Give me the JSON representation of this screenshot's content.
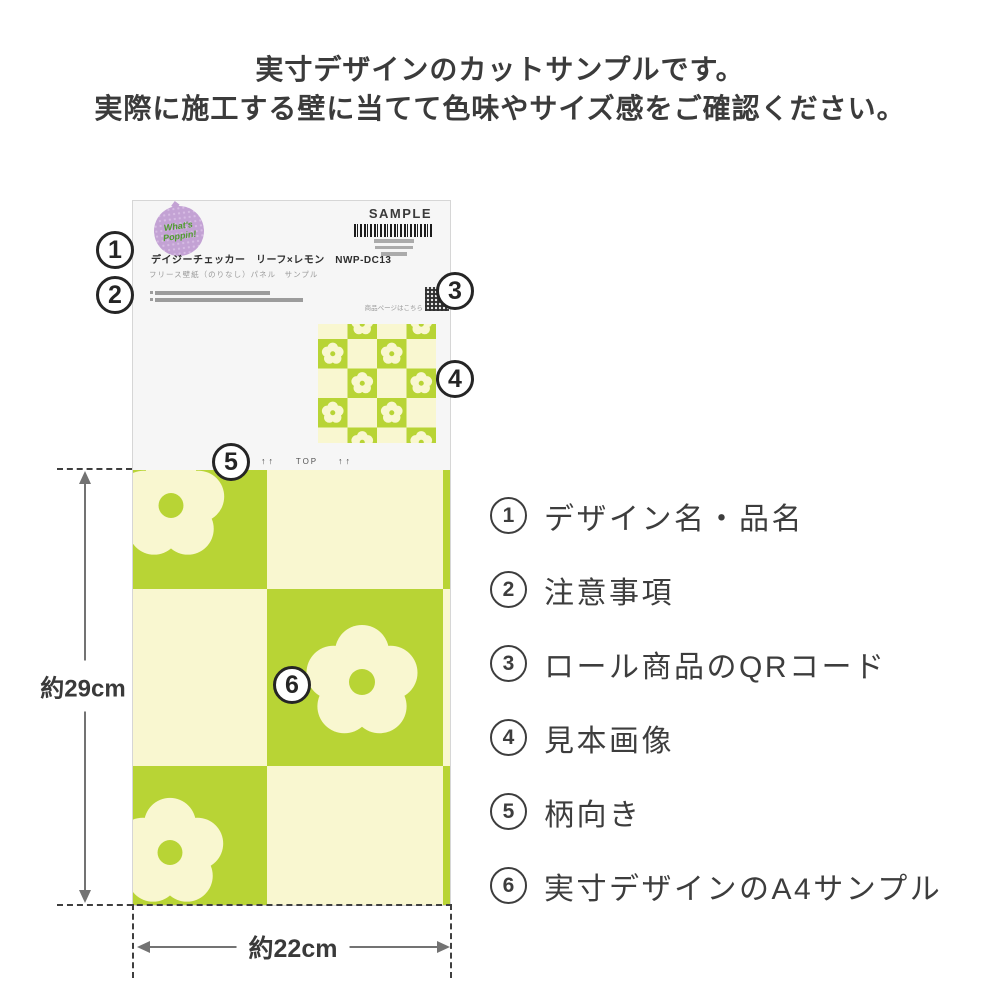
{
  "header": {
    "line1": "実寸デザインのカットサンプルです。",
    "line2": "実際に施工する壁に当てて色味やサイズ感をご確認ください。"
  },
  "sample": {
    "brand_line1": "What's",
    "brand_line2": "Poppin!",
    "sample_label": "SAMPLE",
    "product_name": "デイジーチェッカー　リーフ×レモン　NWP-DC13",
    "product_spec": "フリース壁紙（のりなし）パネル　サンプル",
    "qr_caption": "商品ページはこちら",
    "top_arrows_left": "↑↑",
    "top_label": "TOP",
    "top_arrows_right": "↑↑"
  },
  "dimensions": {
    "height_label": "約29cm",
    "width_label": "約22cm"
  },
  "callouts": {
    "c1": "1",
    "c2": "2",
    "c3": "3",
    "c4": "4",
    "c5": "5",
    "c6": "6"
  },
  "legend": {
    "items": [
      {
        "number": "1",
        "label": "デザイン名・品名"
      },
      {
        "number": "2",
        "label": "注意事項"
      },
      {
        "number": "3",
        "label": "ロール商品のQRコード"
      },
      {
        "number": "4",
        "label": "見本画像"
      },
      {
        "number": "5",
        "label": "柄向き"
      },
      {
        "number": "6",
        "label": "実寸デザインのA4サンプル"
      }
    ]
  },
  "colors": {
    "pattern_green": "#b8d435",
    "pattern_cream": "#f9f7d0",
    "logo_purple": "#c3a2d4",
    "logo_text_green": "#4f9c2e",
    "text_dark": "#3a3a3a"
  }
}
